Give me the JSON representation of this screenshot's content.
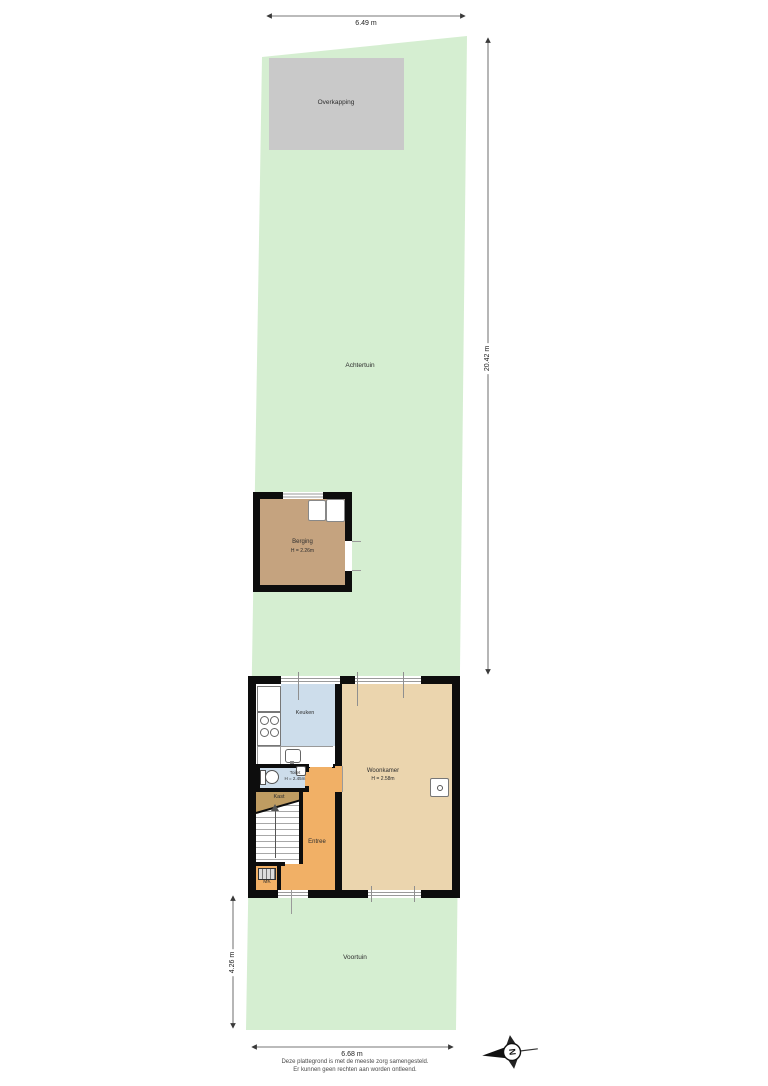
{
  "floorplan": {
    "garden": {
      "back_label": "Achtertuin",
      "front_label": "Voortuin"
    },
    "overkapping": {
      "label": "Overkapping"
    },
    "berging": {
      "label": "Berging",
      "ceiling_height": "H = 2.26m"
    },
    "house": {
      "keuken": {
        "label": "Keuken"
      },
      "woonkamer": {
        "label": "Woonkamer",
        "ceiling_height": "H = 2.58m"
      },
      "toilet": {
        "label": "Toilet",
        "ceiling_height": "H = 2.45m"
      },
      "kast": {
        "label": "Kast"
      },
      "entree": {
        "label": "Entree"
      },
      "meterkast": {
        "label": "MK"
      }
    },
    "dimensions": {
      "plot_width_top": "6.49 m",
      "back_garden_depth": "20.42 m",
      "front_garden_depth": "4.26 m",
      "plot_width_bottom": "6.68 m"
    },
    "compass": {
      "north": "N"
    },
    "footer": {
      "disclaimer_line1": "Deze plattegrond is met de meeste zorg samengesteld.",
      "disclaimer_line2": "Er kunnen geen rechten aan worden ontleend."
    },
    "colors": {
      "garden": "#d5eed1",
      "overkapping": "#c9c9c9",
      "berging_floor": "#c5a37f",
      "kitchen_floor": "#cdddeb",
      "woonkamer_floor": "#ebd5ae",
      "entree_floor": "#f1b066",
      "kast_floor": "#bf9c62",
      "wall": "#0d0d0d",
      "dimension_line": "#4a4a4a"
    }
  }
}
